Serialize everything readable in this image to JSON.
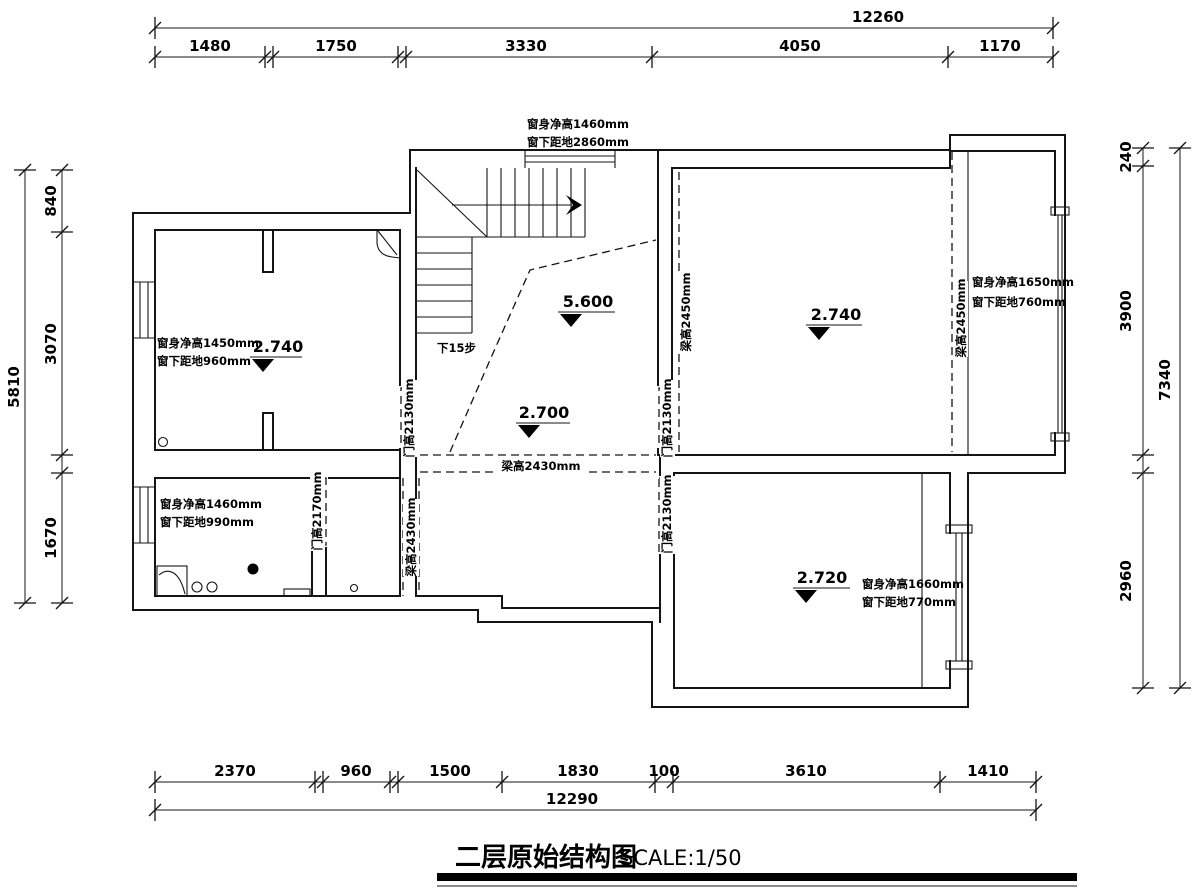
{
  "title": {
    "name": "二层原始结构图",
    "scale": "SCALE:1/50"
  },
  "dims": {
    "top": {
      "total": "12260",
      "segs": [
        "1480",
        "1750",
        "3330",
        "4050",
        "1170"
      ]
    },
    "bottom": {
      "total": "12290",
      "segs": [
        "2370",
        "960",
        "1500",
        "1830",
        "100",
        "3610",
        "1410"
      ]
    },
    "left": {
      "total": "5810",
      "segs": [
        "840",
        "3070",
        "1670"
      ]
    },
    "right": {
      "total": "7340",
      "segs": [
        "240",
        "3900",
        "2960"
      ]
    }
  },
  "annotations": {
    "win_top": {
      "l1": "窗身净高1460mm",
      "l2": "窗下距地2860mm"
    },
    "win_left": {
      "l1": "窗身净高1450mm",
      "l2": "窗下距地960mm"
    },
    "win_bath": {
      "l1": "窗身净高1460mm",
      "l2": "窗下距地990mm"
    },
    "win_right": {
      "l1": "窗身净高1650mm",
      "l2": "窗下距地760mm"
    },
    "win_lower_right": {
      "l1": "窗身净高1660mm",
      "l2": "窗下距地770mm"
    },
    "beam_mid_horizontal": "梁高2430mm",
    "beam_lower_left_vertical": "梁高2430mm",
    "beam_right_wing_left": "梁高2450mm",
    "beam_right_wing_right": "梁高2450mm",
    "door_hall_left": "门高2130mm",
    "door_hall_right": "门高2130mm",
    "door_bath": "门高2170mm",
    "door_lower_right": "门高2130mm",
    "stair_note": "下15步"
  },
  "elevations": {
    "left_room": "2.740",
    "stair": "5.600",
    "hall": "2.700",
    "right_room": "2.740",
    "lower_right_room": "2.720"
  }
}
